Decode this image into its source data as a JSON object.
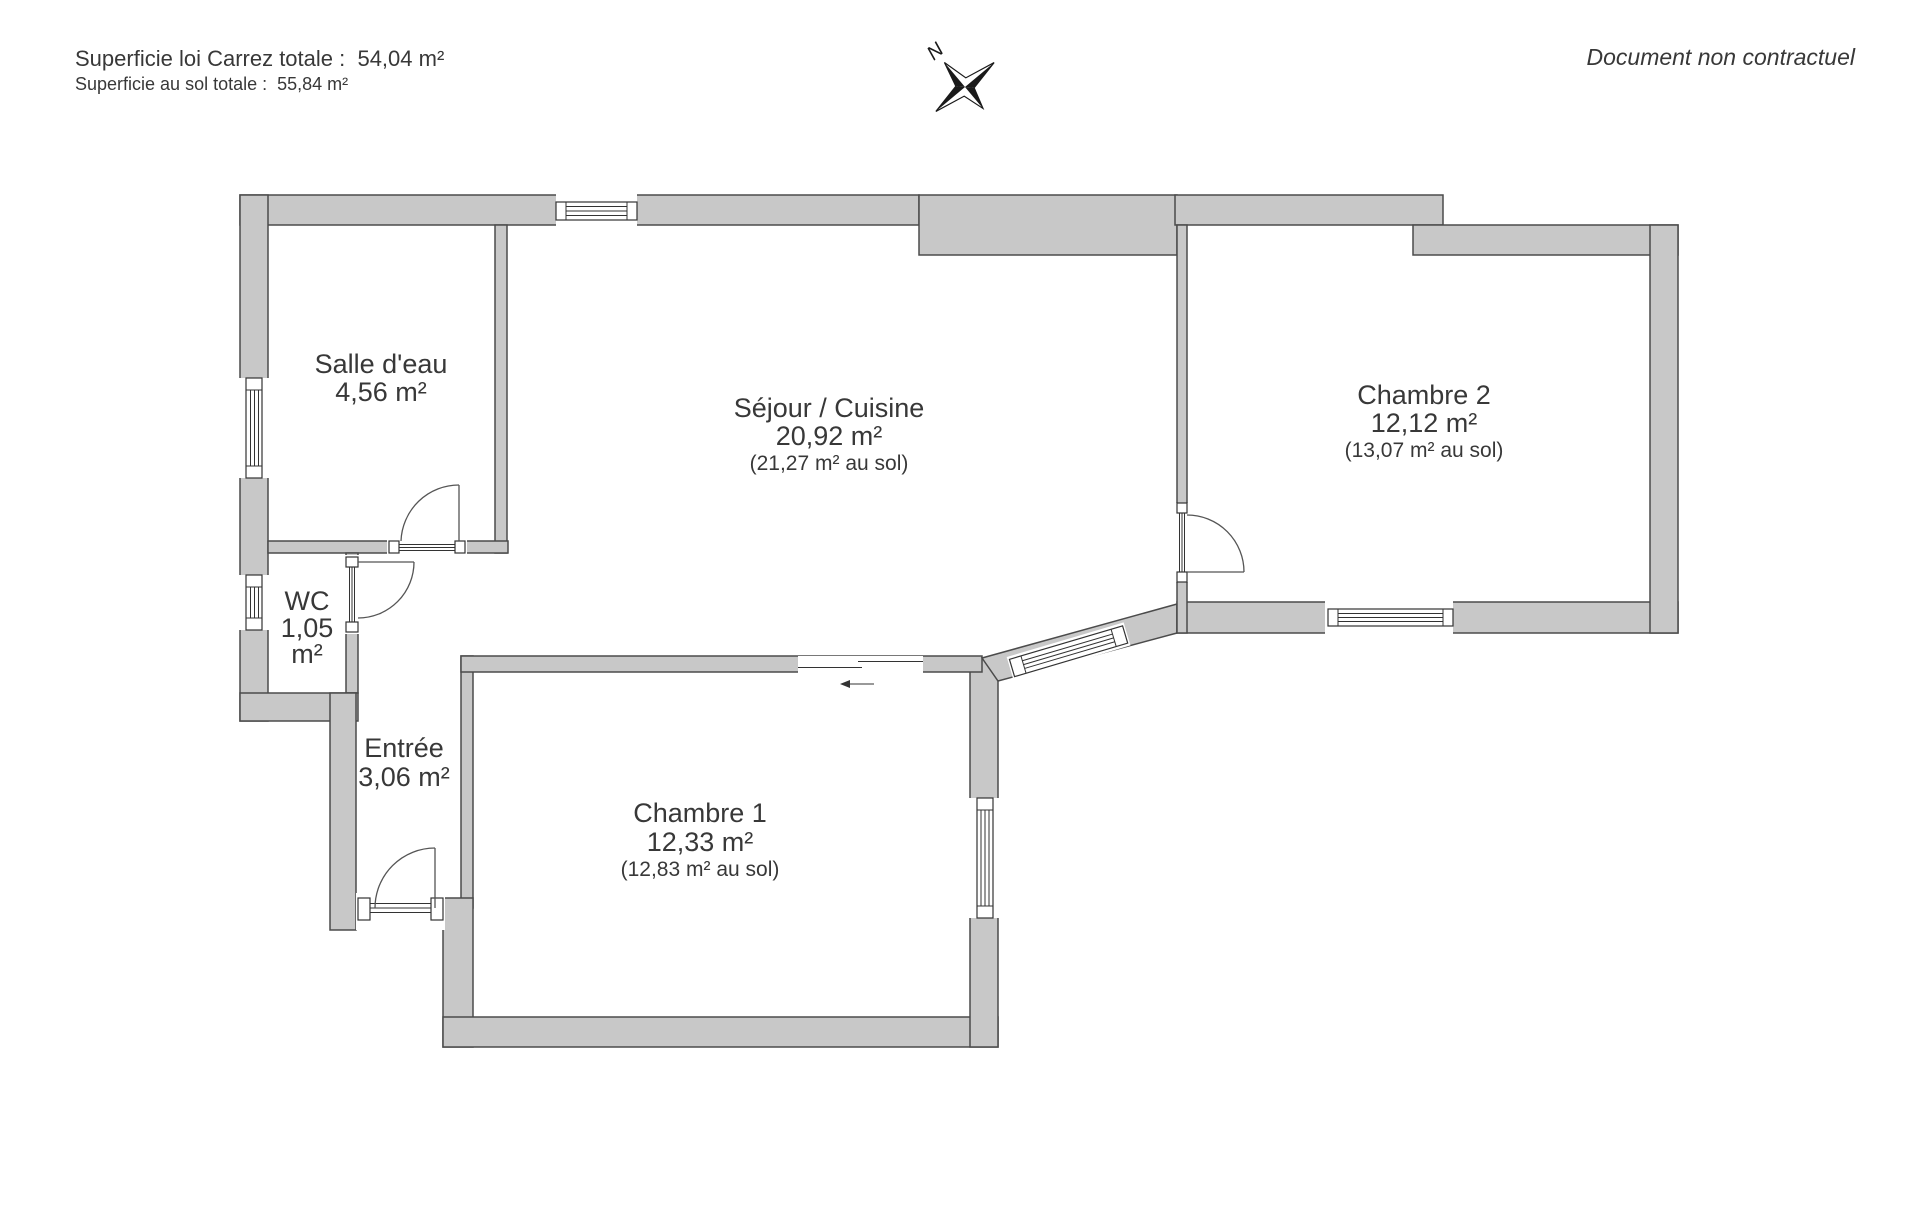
{
  "header": {
    "carrez_total": "Superficie loi Carrez totale :  54,04 m²",
    "floor_total": "Superficie au sol totale :  55,84 m²",
    "disclaimer": "Document non contractuel"
  },
  "compass": {
    "north_label": "N"
  },
  "rooms": {
    "salle_deau": {
      "name": "Salle d'eau",
      "area": "4,56 m²"
    },
    "sejour": {
      "name": "Séjour / Cuisine",
      "area": "20,92 m²",
      "floor": "(21,27 m² au sol)"
    },
    "chambre2": {
      "name": "Chambre 2",
      "area": "12,12 m²",
      "floor": "(13,07 m² au sol)"
    },
    "wc": {
      "name": "WC",
      "area": "1,05",
      "unit": "m²"
    },
    "entree": {
      "name": "Entrée",
      "area": "3,06 m²"
    },
    "chambre1": {
      "name": "Chambre 1",
      "area": "12,33 m²",
      "floor": "(12,83 m² au sol)"
    }
  },
  "colors": {
    "wall_fill": "#c8c8c8",
    "wall_line": "#4b4b4b",
    "detail_line": "#333333",
    "text": "#383838",
    "page_bg": "#ffffff"
  }
}
